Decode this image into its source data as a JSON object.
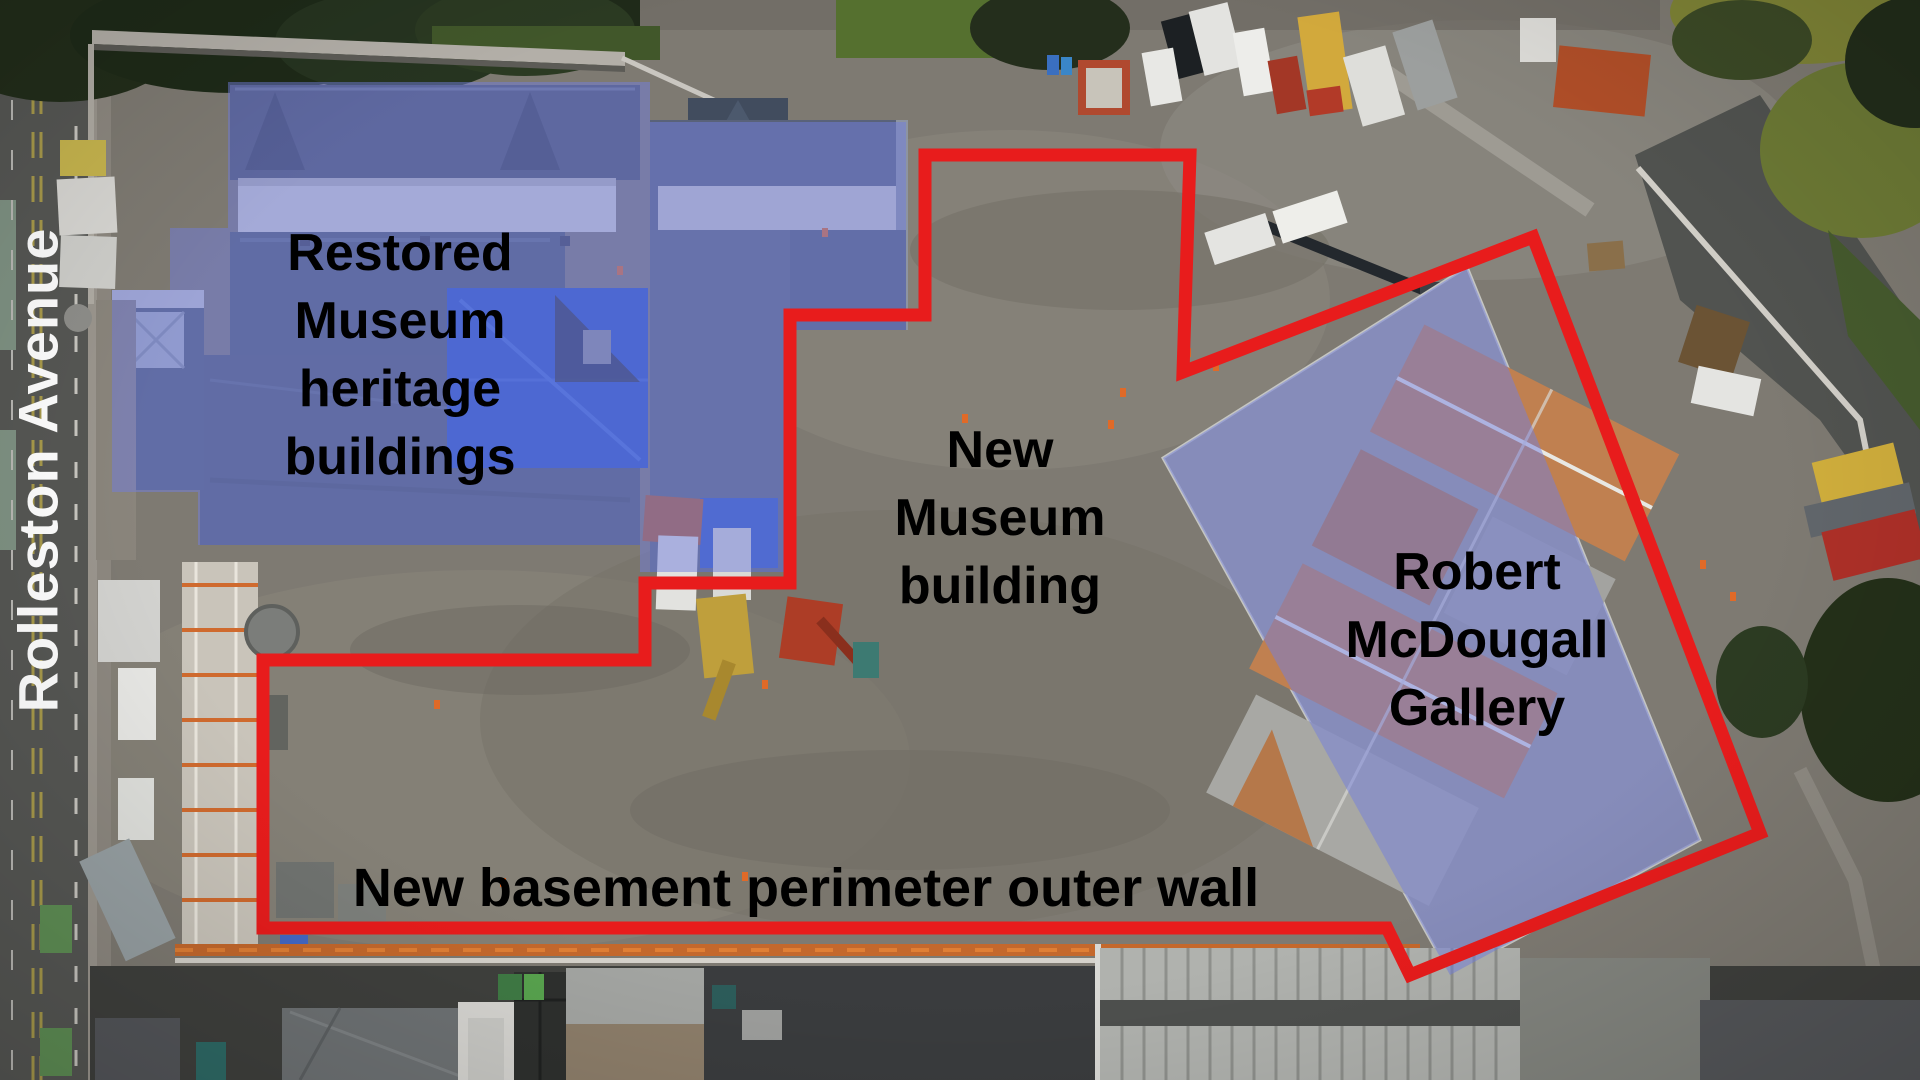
{
  "street_sign": {
    "text": "Rolleston Avenue"
  },
  "labels": {
    "heritage": {
      "lines": [
        "Restored",
        "Museum",
        "heritage",
        "buildings"
      ]
    },
    "new_museum": {
      "lines": [
        "New",
        "Museum",
        "building"
      ]
    },
    "gallery": {
      "lines": [
        "Robert",
        "McDougall",
        "Gallery"
      ]
    },
    "basement_wall": {
      "text": "New basement perimeter outer wall"
    }
  },
  "annotations": {
    "red_outline_points": "925,155 1190,155 1183,372 1533,237 1760,833 1410,975 1387,928 263,928 263,660 645,660 645,583 790,583 790,315 925,315",
    "heritage_overlay_points": "228,82 650,82 650,122 906,122 906,330 788,330 788,572 640,572 640,545 198,545 198,492 112,492 112,290 170,290 170,228 228,228",
    "gallery_overlay_points": "1467,267 1700,840 1450,975 1163,458",
    "colors": {
      "outline_red": "#e81c1c",
      "overlay_blue": "#727ede",
      "label_text": "#000000",
      "street_text": "#ffffff"
    }
  }
}
